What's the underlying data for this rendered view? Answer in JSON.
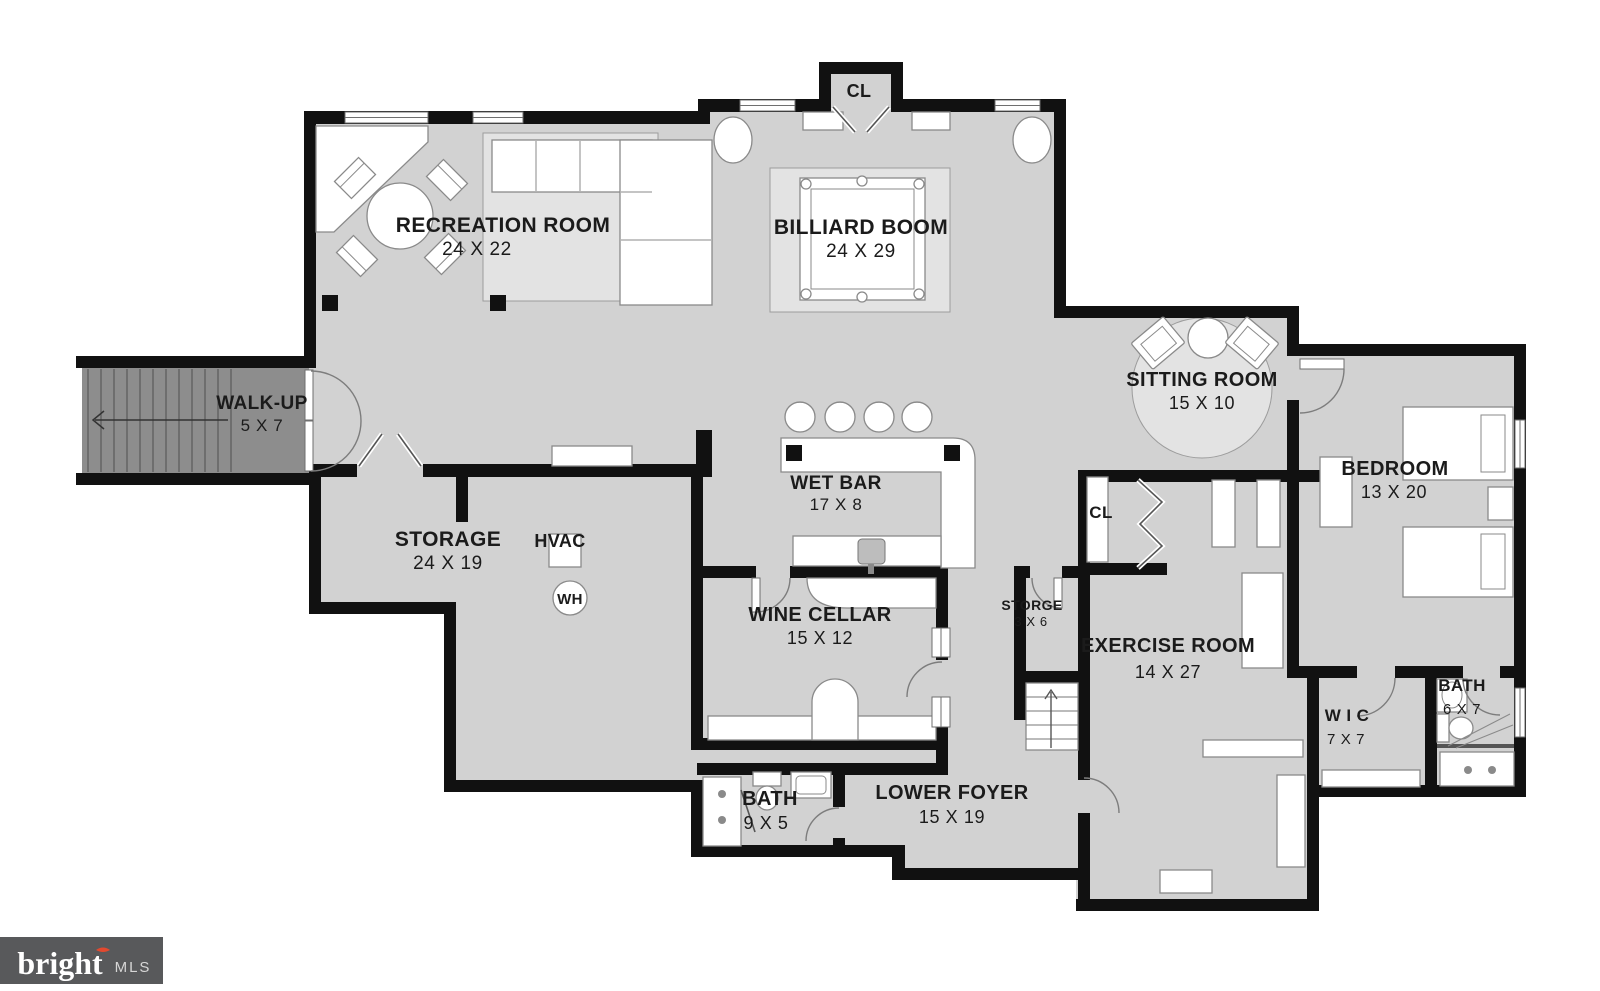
{
  "colors": {
    "wall": "#111111",
    "floor": "#d2d2d2",
    "walkup_floor": "#8d8d8d",
    "rug": "#e3e3e3",
    "logo_background": "#58595b",
    "logo_accent_red": "#e2492f",
    "label_text": "#1b1b1b"
  },
  "rooms": {
    "recreation": {
      "name": "RECREATION ROOM",
      "dims": "24 X 22"
    },
    "billiard": {
      "name": "BILLIARD BOOM",
      "dims": "24 X 29"
    },
    "sitting": {
      "name": "SITTING ROOM",
      "dims": "15 X 10"
    },
    "bedroom": {
      "name": "BEDROOM",
      "dims": "13 X 20"
    },
    "walkup": {
      "name": "WALK-UP",
      "dims": "5 X 7"
    },
    "storage": {
      "name": "STORAGE",
      "dims": "24 X 19"
    },
    "wetbar": {
      "name": "WET BAR",
      "dims": "17 X 8"
    },
    "winecellar": {
      "name": "WINE CELLAR",
      "dims": "15 X 12"
    },
    "storge": {
      "name": "STORGE",
      "dims": "3 X 6"
    },
    "exercise": {
      "name": "EXERCISE ROOM",
      "dims": "14 X 27"
    },
    "wic": {
      "name": "W I C",
      "dims": "7 X 7"
    },
    "bath_small": {
      "name": "BATH",
      "dims": "6 X 7"
    },
    "bath_lower": {
      "name": "BATH",
      "dims": "9 X 5"
    },
    "foyer": {
      "name": "LOWER FOYER",
      "dims": "15 X 19"
    }
  },
  "closets": {
    "billiard_closet": "CL",
    "exercise_closet": "CL"
  },
  "utilities": {
    "hvac": "HVAC",
    "water_heater": "WH"
  },
  "logo": {
    "brand": "bright",
    "suffix": "MLS"
  }
}
